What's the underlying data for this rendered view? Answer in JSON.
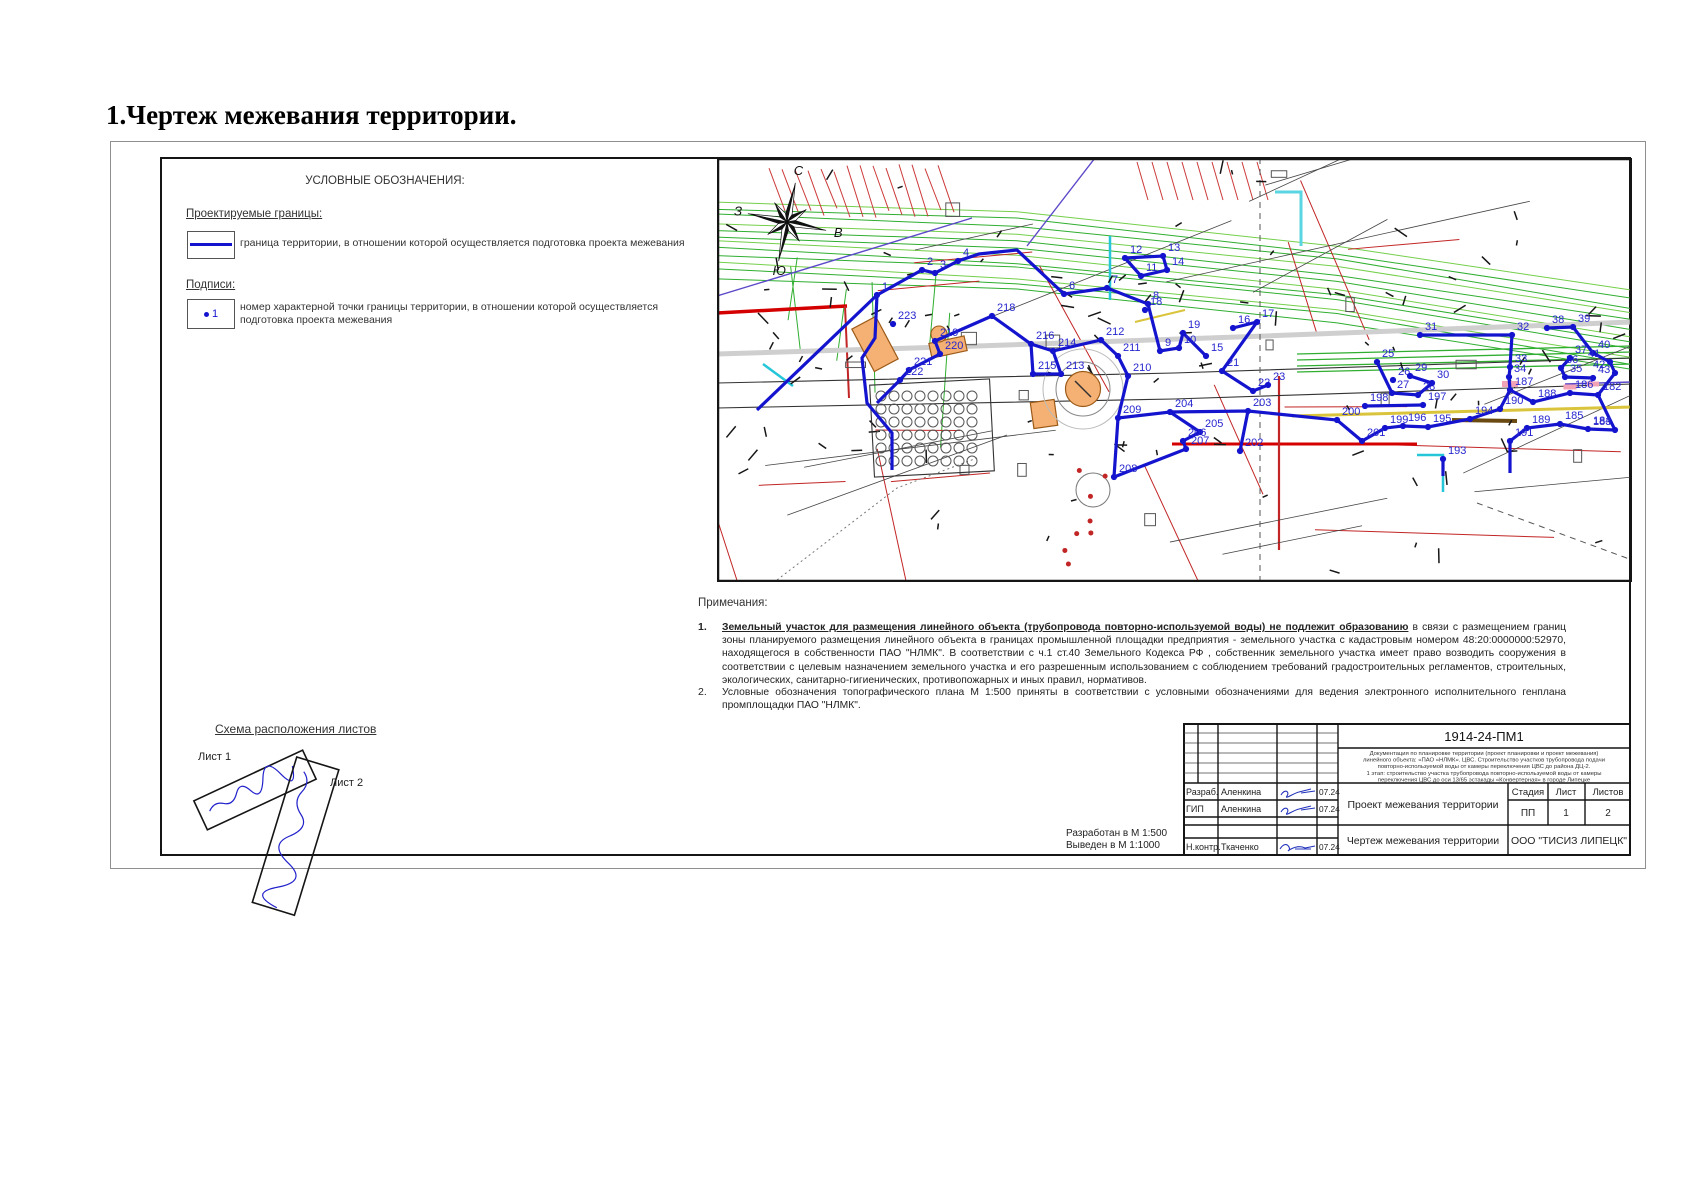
{
  "page": {
    "title": "1.Чертеж межевания территории."
  },
  "legend": {
    "header": "УСЛОВНЫЕ ОБОЗНАЧЕНИЯ:",
    "group_boundaries": "Проектируемые границы:",
    "boundary_desc": "граница территории, в отношении которой осуществляется подготовка проекта межевания",
    "group_labels": "Подписи:",
    "point_sample": "1",
    "point_desc": "номер характерной точки границы территории, в отношении которой осуществляется подготовка проекта межевания"
  },
  "map": {
    "compass": {
      "north": "С",
      "south": "Ю",
      "west": "З",
      "east": "В"
    },
    "boundary_color": "#1414cf",
    "label_color": "#2626cf",
    "points": [
      [
        "1",
        160,
        137
      ],
      [
        "2",
        205,
        112
      ],
      [
        "3",
        218,
        115
      ],
      [
        "4",
        241,
        103
      ],
      [
        "6",
        347,
        136
      ],
      [
        "7",
        390,
        130
      ],
      [
        "8",
        431,
        146
      ],
      [
        "9",
        443,
        193
      ],
      [
        "10",
        462,
        190
      ],
      [
        "11",
        424,
        118
      ],
      [
        "12",
        408,
        100
      ],
      [
        "13",
        446,
        98
      ],
      [
        "14",
        450,
        112
      ],
      [
        "15",
        489,
        198
      ],
      [
        "16",
        516,
        170
      ],
      [
        "17",
        540,
        164
      ],
      [
        "18",
        428,
        152
      ],
      [
        "19",
        466,
        175
      ],
      [
        "21",
        505,
        213
      ],
      [
        "22",
        536,
        233
      ],
      [
        "23",
        551,
        227
      ],
      [
        "25",
        660,
        204
      ],
      [
        "26",
        676,
        222
      ],
      [
        "27",
        675,
        235
      ],
      [
        "28",
        701,
        237
      ],
      [
        "29",
        693,
        218
      ],
      [
        "30",
        715,
        225
      ],
      [
        "31",
        703,
        177
      ],
      [
        "32",
        795,
        177
      ],
      [
        "33",
        793,
        209
      ],
      [
        "34",
        792,
        219
      ],
      [
        "35",
        848,
        219
      ],
      [
        "36",
        844,
        210
      ],
      [
        "37",
        853,
        200
      ],
      [
        "38",
        830,
        170
      ],
      [
        "39",
        856,
        169
      ],
      [
        "40",
        876,
        195
      ],
      [
        "41",
        893,
        204
      ],
      [
        "42",
        898,
        215
      ],
      [
        "43",
        876,
        220
      ],
      [
        "182",
        881,
        237
      ],
      [
        "183",
        898,
        272
      ],
      [
        "184",
        871,
        271
      ],
      [
        "185",
        843,
        266
      ],
      [
        "186",
        853,
        235
      ],
      [
        "187",
        793,
        232
      ],
      [
        "188",
        816,
        244
      ],
      [
        "189",
        810,
        270
      ],
      [
        "190",
        783,
        251
      ],
      [
        "191",
        793,
        283
      ],
      [
        "193",
        726,
        301
      ],
      [
        "194",
        753,
        261
      ],
      [
        "195",
        711,
        269
      ],
      [
        "196",
        686,
        268
      ],
      [
        "197",
        706,
        247
      ],
      [
        "198",
        648,
        248
      ],
      [
        "199",
        668,
        270
      ],
      [
        "200",
        620,
        262
      ],
      [
        "201",
        645,
        283
      ],
      [
        "202",
        523,
        293
      ],
      [
        "203",
        531,
        253
      ],
      [
        "204",
        453,
        254
      ],
      [
        "205",
        483,
        274
      ],
      [
        "206",
        466,
        283
      ],
      [
        "207",
        469,
        291
      ],
      [
        "208",
        397,
        319
      ],
      [
        "209",
        401,
        260
      ],
      [
        "210",
        411,
        218
      ],
      [
        "211",
        401,
        198
      ],
      [
        "212",
        384,
        182
      ],
      [
        "213",
        344,
        216
      ],
      [
        "214",
        336,
        193
      ],
      [
        "215",
        316,
        216
      ],
      [
        "216",
        314,
        186
      ],
      [
        "218",
        275,
        158
      ],
      [
        "219",
        218,
        183
      ],
      [
        "220",
        223,
        196
      ],
      [
        "221",
        192,
        212
      ],
      [
        "222",
        183,
        222
      ],
      [
        "223",
        176,
        166
      ]
    ],
    "strokes": [
      [
        [
          40,
          252
        ],
        [
          160,
          137
        ],
        [
          205,
          112
        ],
        [
          218,
          115
        ],
        [
          241,
          103
        ],
        [
          262,
          96
        ],
        [
          300,
          92
        ],
        [
          347,
          136
        ],
        [
          390,
          130
        ],
        [
          431,
          146
        ]
      ],
      [
        [
          408,
          100
        ],
        [
          446,
          98
        ],
        [
          450,
          112
        ],
        [
          424,
          118
        ],
        [
          408,
          100
        ]
      ],
      [
        [
          431,
          146
        ],
        [
          443,
          193
        ],
        [
          462,
          190
        ],
        [
          466,
          175
        ],
        [
          489,
          198
        ]
      ],
      [
        [
          160,
          137
        ],
        [
          158,
          180
        ],
        [
          145,
          200
        ],
        [
          150,
          245
        ],
        [
          175,
          275
        ],
        [
          175,
          312
        ]
      ],
      [
        [
          275,
          158
        ],
        [
          218,
          183
        ],
        [
          223,
          196
        ],
        [
          192,
          212
        ],
        [
          183,
          222
        ],
        [
          160,
          245
        ]
      ],
      [
        [
          275,
          158
        ],
        [
          314,
          186
        ],
        [
          336,
          193
        ],
        [
          384,
          182
        ],
        [
          401,
          198
        ],
        [
          411,
          218
        ],
        [
          401,
          260
        ],
        [
          397,
          319
        ]
      ],
      [
        [
          314,
          186
        ],
        [
          316,
          216
        ],
        [
          344,
          216
        ],
        [
          336,
          193
        ]
      ],
      [
        [
          397,
          319
        ],
        [
          469,
          291
        ],
        [
          466,
          283
        ],
        [
          483,
          274
        ],
        [
          453,
          254
        ],
        [
          401,
          260
        ]
      ],
      [
        [
          453,
          254
        ],
        [
          531,
          253
        ],
        [
          523,
          293
        ]
      ],
      [
        [
          531,
          253
        ],
        [
          620,
          262
        ],
        [
          645,
          283
        ],
        [
          668,
          270
        ],
        [
          686,
          268
        ],
        [
          711,
          269
        ],
        [
          753,
          261
        ],
        [
          783,
          251
        ]
      ],
      [
        [
          516,
          170
        ],
        [
          540,
          164
        ],
        [
          505,
          213
        ],
        [
          536,
          233
        ],
        [
          551,
          227
        ]
      ],
      [
        [
          660,
          204
        ],
        [
          675,
          235
        ],
        [
          701,
          237
        ],
        [
          715,
          225
        ],
        [
          693,
          218
        ]
      ],
      [
        [
          648,
          248
        ],
        [
          706,
          247
        ]
      ],
      [
        [
          703,
          177
        ],
        [
          795,
          177
        ],
        [
          793,
          209
        ],
        [
          792,
          219
        ],
        [
          793,
          232
        ],
        [
          783,
          251
        ]
      ],
      [
        [
          830,
          170
        ],
        [
          856,
          169
        ],
        [
          876,
          195
        ],
        [
          893,
          204
        ],
        [
          898,
          215
        ],
        [
          881,
          237
        ],
        [
          898,
          272
        ],
        [
          871,
          271
        ],
        [
          843,
          266
        ],
        [
          810,
          270
        ],
        [
          793,
          283
        ],
        [
          793,
          315
        ]
      ],
      [
        [
          853,
          200
        ],
        [
          844,
          210
        ],
        [
          848,
          219
        ],
        [
          876,
          220
        ]
      ],
      [
        [
          793,
          232
        ],
        [
          816,
          244
        ],
        [
          853,
          235
        ],
        [
          881,
          237
        ]
      ],
      [
        [
          726,
          301
        ],
        [
          726,
          318
        ]
      ]
    ]
  },
  "notes": {
    "header": "Примечания:",
    "items": [
      {
        "num": "1.",
        "lead": "Земельный участок для размещения линейного объекта (трубопровода повторно-используемой воды) не подлежит образованию",
        "text": " в связи с размещением границ зоны планируемого размещения линейного объекта в  границах промышленной площадки предприятия - земельного участка с кадастровым номером 48:20:0000000:52970, находящегося в собственности ПАО \"НЛМК\". В соответствии с ч.1 ст.40 Земельного Кодекса РФ , собственник земельного участка имеет право возводить сооружения в соответствии с целевым назначением земельного участка и его разрешенным использованием с соблюдением требований градостроительных регламентов, строительных, экологических, санитарно-гигиенических, противопожарных и иных правил, нормативов."
      },
      {
        "num": "2.",
        "lead": "",
        "text": "Условные обозначения топографического плана М 1:500 приняты в соответствии с условными обозначениями для ведения электронного исполнительного генплана промплощадки ПАО \"НЛМК\"."
      }
    ]
  },
  "scheme": {
    "header": "Схема расположения листов",
    "sheet1": "Лист 1",
    "sheet2": "Лист 2"
  },
  "plot_note": {
    "line1": "Разработан в М 1:500",
    "line2": "Выведен в М 1:1000"
  },
  "title_block": {
    "doc_number": "1914-24-ПМ1",
    "description_lines": [
      "Документация по планировке территории (проект планировки и проект межевания)",
      "линейного объекта: «ПАО «НЛМК». ЦВС. Строительство участков трубопровода подачи",
      "повторно-используемой воды от камеры переключения ЦВС до района ДЦ-2.",
      "1 этап: строительство участка трубопровода повторно-используемой воды от камеры",
      "переключения ЦВС до оси 13/65 эстакады «Конвертерная» в городе Липецке"
    ],
    "rows": [
      {
        "role": "Разраб.",
        "name": "Аленкина",
        "date": "07.24"
      },
      {
        "role": "ГИП",
        "name": "Аленкина",
        "date": "07.24"
      },
      {
        "role": "Н.контр.",
        "name": "Ткаченко",
        "date": "07.24"
      }
    ],
    "project_title": "Проект межевания территории",
    "sheet_title": "Чертеж межевания территории",
    "stage_label": "Стадия",
    "sheet_label": "Лист",
    "sheets_label": "Листов",
    "stage": "ПП",
    "sheet_num": "1",
    "sheets_total": "2",
    "company": "ООО \"ТИСИЗ ЛИПЕЦК\""
  }
}
